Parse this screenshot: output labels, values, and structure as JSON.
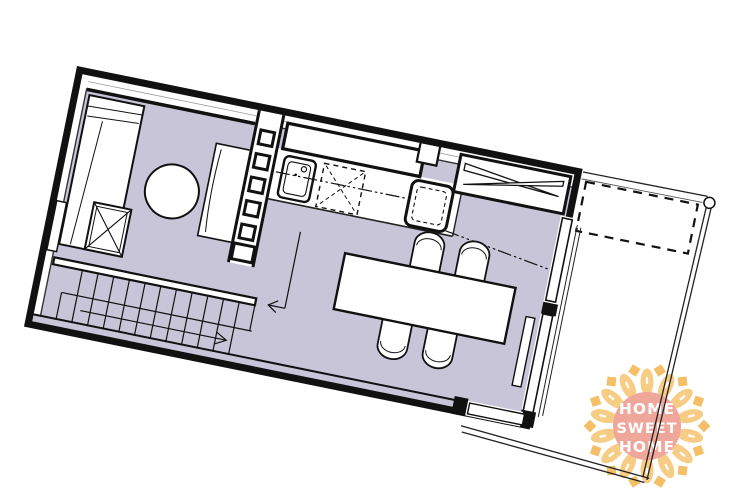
{
  "page": {
    "background": "#ffffff",
    "content": "apartment floor plan drawing, rotated"
  },
  "colors": {
    "floor": "#c8c5d8",
    "wall": "#111111",
    "line": "#222222",
    "logo_petal": "#f7cd85",
    "logo_petal_dark": "#f4bf66",
    "logo_center": "#efa69b",
    "logo_text": "#ffffff"
  },
  "logo": {
    "line1": "HOME",
    "line2": "SWEET",
    "line3": "HOME"
  },
  "plan": {
    "rotation_deg": 11.5,
    "furniture": [
      "bed",
      "bedside-table",
      "storage-chest",
      "round-rug",
      "desk-cabinet",
      "shelving-divider",
      "kitchen-wall-cabinet",
      "sink",
      "dishwasher",
      "oven",
      "sliding-wardrobe",
      "dining-table",
      "chair",
      "staircase",
      "stair-direction-arrow",
      "sliding-glass-door",
      "balcony",
      "balcony-railing",
      "balcony-skylight"
    ]
  }
}
